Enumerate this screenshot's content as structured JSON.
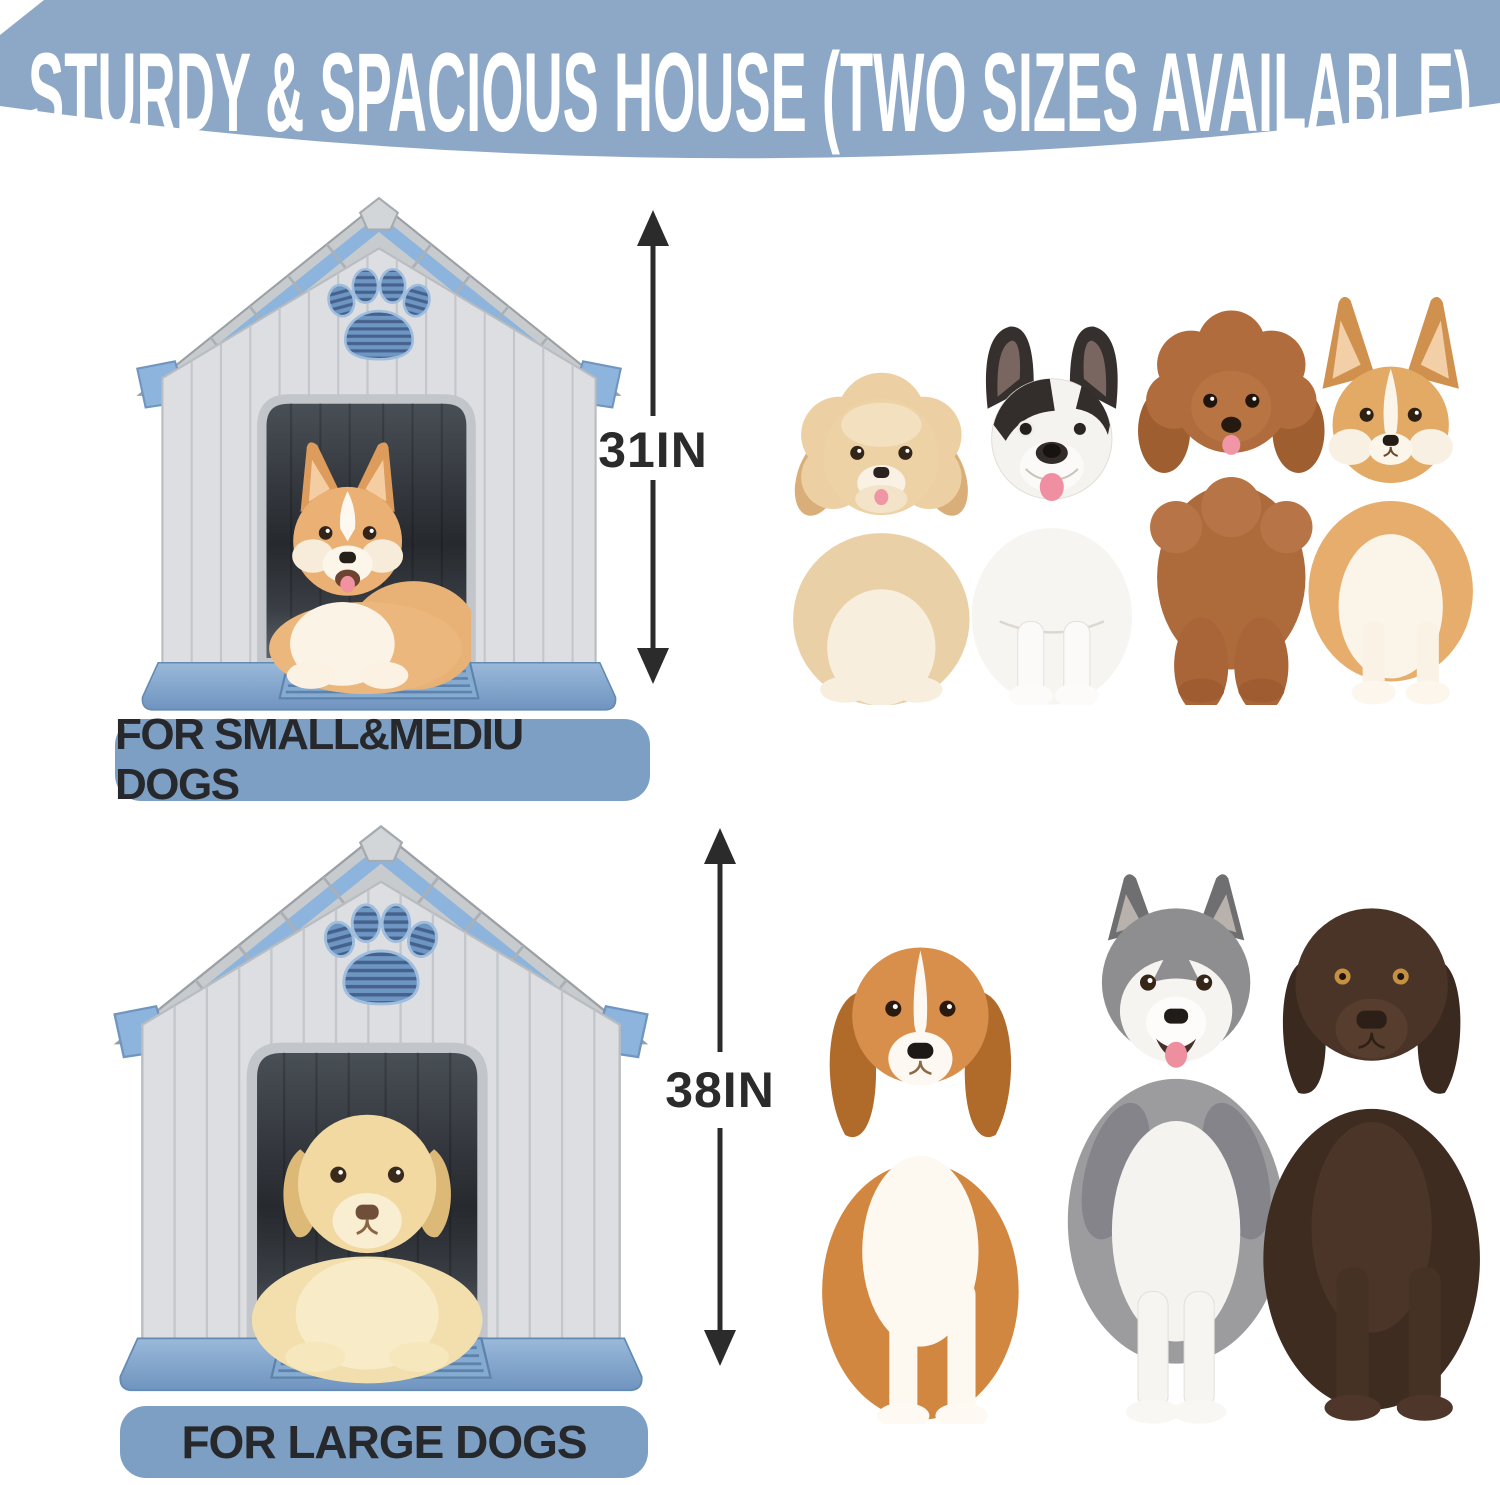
{
  "banner": {
    "title": "STURDY & SPACIOUS HOUSE (TWO SIZES AVAILABLE)",
    "bg_color": "#8da8c7",
    "text_color": "#ffffff"
  },
  "small_section": {
    "height_label": "31IN",
    "caption": "FOR SMALL&MEDIU DOGS",
    "house_dog": "corgi-puppy",
    "dog_icons": [
      "havanese",
      "french-bulldog",
      "toy-poodle",
      "corgi"
    ]
  },
  "large_section": {
    "height_label": "38IN",
    "caption": "FOR LARGE DOGS",
    "house_dog": "labrador-puppy",
    "dog_icons": [
      "beagle",
      "husky",
      "chocolate-labrador"
    ]
  },
  "colors": {
    "banner_blue": "#8da8c7",
    "label_blue": "#7e9fc4",
    "roof_trim_blue": "#8db4dc",
    "base_blue": "#7fa5cd",
    "paw_vent_blue": "#6d96c3",
    "wall_gray": "#dcdee1",
    "roof_gray": "#c8cbce",
    "arrow_text_dark": "#2b2b2b"
  }
}
